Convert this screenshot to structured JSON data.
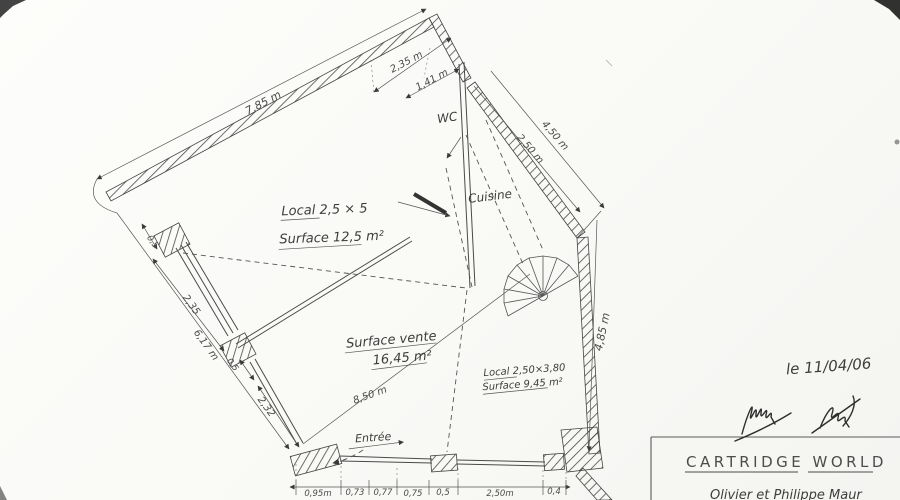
{
  "plan": {
    "room_labels": {
      "local1": {
        "line1": "Local 2,5 × 5",
        "line2": "Surface 12,5 m²"
      },
      "vente": {
        "line1": "Surface vente",
        "line2": "16,45 m²"
      },
      "local2": {
        "line1": "Local 2,50×3,80",
        "line2": "Surface 9,45 m²"
      },
      "wc": "WC",
      "cuisine": "Cuisine",
      "entree": "Entrée"
    },
    "dimensions": {
      "top_total": "7,85 m",
      "top_a": "2,35 m",
      "top_b": "1,41 m",
      "corridor_inner": "2,50 m",
      "corridor_outer": "4,50 m",
      "right": "4,85 m",
      "left_outer": "6,17 m",
      "left_upper": "2,35",
      "left_lower": "2,32",
      "left_small_top": "0,5",
      "left_small_mid": "0,5",
      "diagonal": "8,50 m",
      "bottom": [
        "0,95m",
        "0,73",
        "0,77",
        "0,75",
        "0,5",
        "2,50m",
        "0,4"
      ]
    },
    "annotations": {
      "date": "le 11/04/06",
      "company": "CARTRIDGE  WORLD",
      "clients": "Olivier  et  Philippe  Maur"
    }
  }
}
